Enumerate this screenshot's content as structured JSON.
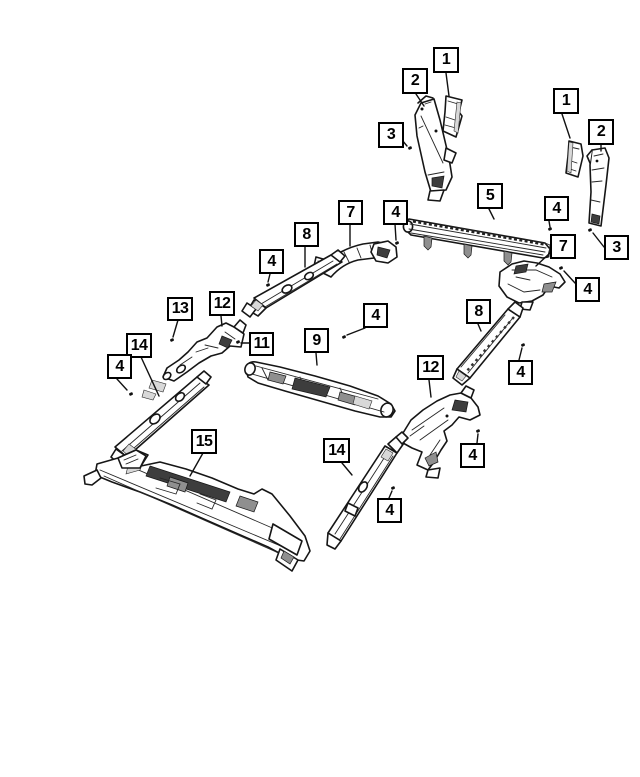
{
  "diagram": {
    "title": "body-parts-exploded-diagram",
    "colors": {
      "background": "#ffffff",
      "line": "#161616",
      "callout_border": "#000000",
      "callout_fill": "#ffffff",
      "callout_text": "#000000"
    },
    "callouts": [
      {
        "label": "1",
        "x": 433,
        "y": 47,
        "w": 26,
        "h": 26,
        "leader": [
          [
            446,
            73
          ],
          [
            449,
            96
          ]
        ]
      },
      {
        "label": "2",
        "x": 402,
        "y": 68,
        "w": 26,
        "h": 26,
        "leader": [
          [
            416,
            94
          ],
          [
            424,
            106
          ]
        ]
      },
      {
        "label": "3",
        "x": 378,
        "y": 122,
        "w": 26,
        "h": 26,
        "leader": [
          [
            402,
            140
          ],
          [
            407,
            146
          ]
        ],
        "dot": [
          410,
          148
        ]
      },
      {
        "label": "1",
        "x": 553,
        "y": 88,
        "w": 26,
        "h": 26,
        "leader": [
          [
            562,
            114
          ],
          [
            570,
            138
          ]
        ]
      },
      {
        "label": "2",
        "x": 588,
        "y": 119,
        "w": 26,
        "h": 26,
        "leader": [
          [
            601,
            145
          ],
          [
            601,
            151
          ]
        ]
      },
      {
        "label": "5",
        "x": 477,
        "y": 183,
        "w": 26,
        "h": 26,
        "leader": [
          [
            489,
            209
          ],
          [
            494,
            219
          ]
        ]
      },
      {
        "label": "4",
        "x": 544,
        "y": 196,
        "w": 25,
        "h": 25,
        "leader": [
          [
            549,
            221
          ],
          [
            550,
            227
          ]
        ],
        "dot": [
          550,
          229
        ]
      },
      {
        "label": "7",
        "x": 550,
        "y": 234,
        "w": 26,
        "h": 25,
        "leader": [
          [
            550,
            253
          ],
          [
            536,
            266
          ]
        ]
      },
      {
        "label": "3",
        "x": 604,
        "y": 235,
        "w": 25,
        "h": 25,
        "leader": [
          [
            604,
            247
          ],
          [
            593,
            233
          ]
        ],
        "dot": [
          590,
          230
        ]
      },
      {
        "label": "4",
        "x": 575,
        "y": 277,
        "w": 25,
        "h": 25,
        "leader": [
          [
            575,
            283
          ],
          [
            564,
            271
          ]
        ],
        "dot": [
          561,
          268
        ]
      },
      {
        "label": "8",
        "x": 466,
        "y": 299,
        "w": 25,
        "h": 25,
        "leader": [
          [
            478,
            324
          ],
          [
            481,
            331
          ]
        ]
      },
      {
        "label": "4",
        "x": 508,
        "y": 360,
        "w": 25,
        "h": 25,
        "leader": [
          [
            519,
            360
          ],
          [
            522,
            348
          ]
        ],
        "dot": [
          523,
          345
        ]
      },
      {
        "label": "12",
        "x": 417,
        "y": 355,
        "w": 27,
        "h": 25,
        "leader": [
          [
            429,
            380
          ],
          [
            431,
            397
          ]
        ]
      },
      {
        "label": "4",
        "x": 460,
        "y": 443,
        "w": 25,
        "h": 25,
        "leader": [
          [
            477,
            443
          ],
          [
            478,
            434
          ]
        ],
        "dot": [
          478,
          431
        ]
      },
      {
        "label": "14",
        "x": 323,
        "y": 438,
        "w": 27,
        "h": 25,
        "leader": [
          [
            342,
            463
          ],
          [
            352,
            475
          ]
        ]
      },
      {
        "label": "4",
        "x": 377,
        "y": 498,
        "w": 25,
        "h": 25,
        "leader": [
          [
            389,
            498
          ],
          [
            392,
            491
          ]
        ],
        "dot": [
          393,
          488
        ]
      },
      {
        "label": "7",
        "x": 338,
        "y": 200,
        "w": 25,
        "h": 25,
        "leader": [
          [
            350,
            225
          ],
          [
            350,
            246
          ]
        ]
      },
      {
        "label": "4",
        "x": 383,
        "y": 200,
        "w": 25,
        "h": 25,
        "leader": [
          [
            395,
            224
          ],
          [
            396,
            240
          ]
        ],
        "dot": [
          397,
          243
        ]
      },
      {
        "label": "8",
        "x": 294,
        "y": 222,
        "w": 25,
        "h": 25,
        "leader": [
          [
            305,
            247
          ],
          [
            305,
            267
          ]
        ]
      },
      {
        "label": "4",
        "x": 259,
        "y": 249,
        "w": 25,
        "h": 25,
        "leader": [
          [
            270,
            274
          ],
          [
            268,
            282
          ]
        ],
        "dot": [
          268,
          285
        ]
      },
      {
        "label": "9",
        "x": 304,
        "y": 328,
        "w": 25,
        "h": 25,
        "leader": [
          [
            316,
            353
          ],
          [
            317,
            365
          ]
        ]
      },
      {
        "label": "4",
        "x": 363,
        "y": 303,
        "w": 25,
        "h": 25,
        "leader": [
          [
            365,
            328
          ],
          [
            347,
            335
          ]
        ],
        "dot": [
          344,
          337
        ]
      },
      {
        "label": "11",
        "x": 249,
        "y": 332,
        "w": 25,
        "h": 24,
        "leader": [
          [
            249,
            343
          ],
          [
            241,
            343
          ]
        ],
        "dot": [
          238,
          342
        ]
      },
      {
        "label": "13",
        "x": 167,
        "y": 297,
        "w": 26,
        "h": 24,
        "leader": [
          [
            178,
            320
          ],
          [
            173,
            337
          ]
        ],
        "dot": [
          172,
          340
        ]
      },
      {
        "label": "12",
        "x": 209,
        "y": 291,
        "w": 26,
        "h": 25,
        "leader": [
          [
            221,
            316
          ],
          [
            222,
            326
          ]
        ]
      },
      {
        "label": "14",
        "x": 126,
        "y": 333,
        "w": 26,
        "h": 25,
        "leader": [
          [
            141,
            357
          ],
          [
            159,
            396
          ]
        ]
      },
      {
        "label": "4",
        "x": 107,
        "y": 354,
        "w": 25,
        "h": 25,
        "leader": [
          [
            117,
            379
          ],
          [
            127,
            390
          ]
        ],
        "dot": [
          131,
          394
        ]
      },
      {
        "label": "15",
        "x": 191,
        "y": 429,
        "w": 26,
        "h": 25,
        "leader": [
          [
            203,
            453
          ],
          [
            190,
            476
          ]
        ]
      }
    ]
  }
}
